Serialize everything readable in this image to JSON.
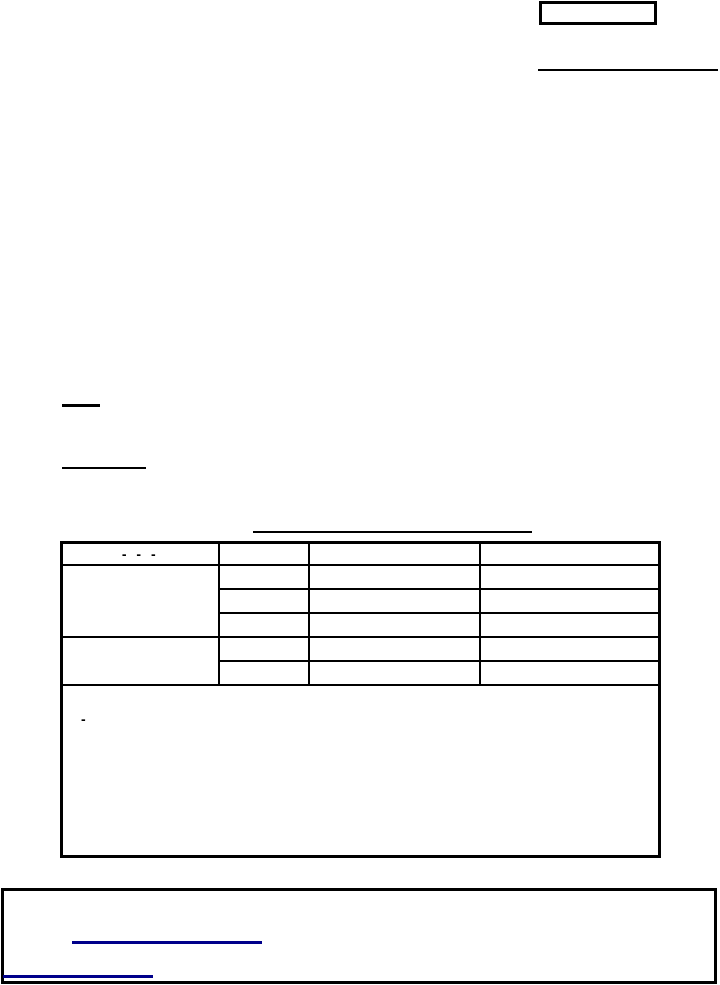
{
  "page": {
    "background_color": "#ffffff"
  },
  "colors": {
    "line": "#000000",
    "link": "#00008B"
  },
  "header": {
    "box_text": "",
    "rule_text": ""
  },
  "body": {
    "blank_label_1": "",
    "blank_label_2": "",
    "table_title": ""
  },
  "table": {
    "header_dashes": "- - -",
    "header_cells": [
      "",
      "",
      ""
    ],
    "group1_label": "",
    "group1_rows": [
      [
        "",
        "",
        ""
      ],
      [
        "",
        "",
        ""
      ],
      [
        "",
        "",
        ""
      ]
    ],
    "group2_label": "",
    "group2_rows": [
      [
        "",
        "",
        ""
      ],
      [
        "",
        "",
        ""
      ]
    ],
    "note_dash": "-"
  },
  "footer": {
    "link_1_text": "",
    "link_2_text": ""
  }
}
